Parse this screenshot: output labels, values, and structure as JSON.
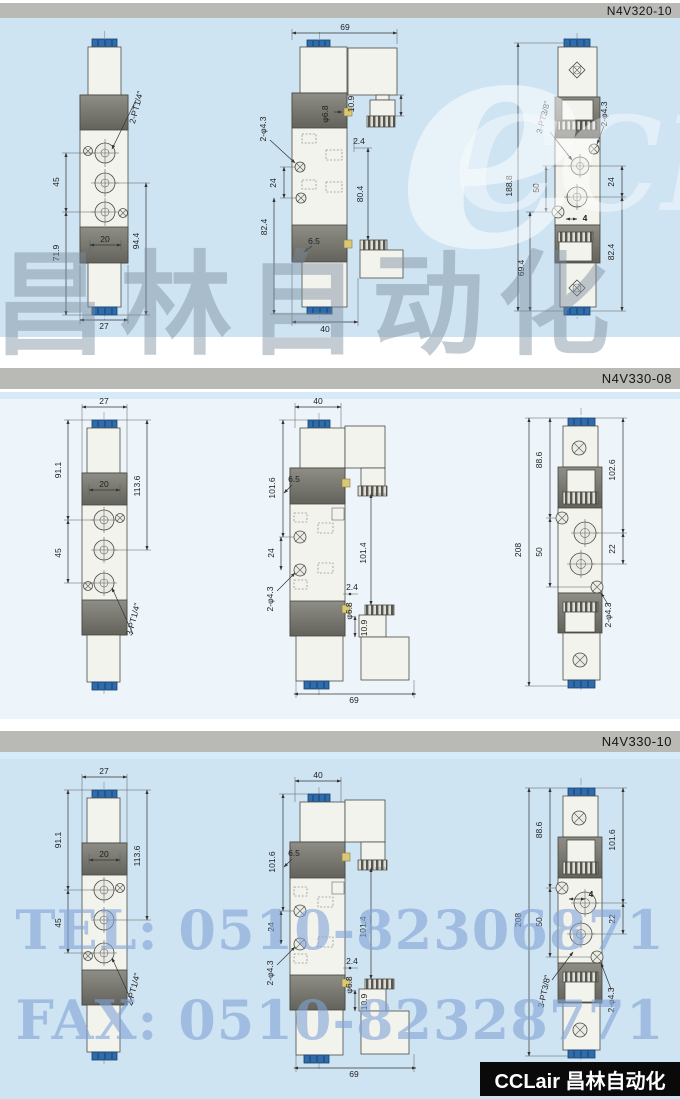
{
  "headers": [
    {
      "model": "N4V320-10"
    },
    {
      "model": "N4V330-08"
    },
    {
      "model": "N4V330-10"
    }
  ],
  "watermarks": {
    "brand": "CCLair",
    "logo_glyph": "e",
    "brand_cn": "昌林自动化",
    "tel": "TEL: 0510-82306871",
    "fax": "FAX: 0510-82328771",
    "footer": "CCLair 昌林自动化"
  },
  "sections": [
    {
      "model": "N4V320-10",
      "front": {
        "w27": "27",
        "d45": "45",
        "d719": "71.9",
        "d20": "20",
        "d944": "94.4",
        "port": "2-PT1/4\""
      },
      "side": {
        "w69": "69",
        "w40": "40",
        "d109": "10.9",
        "d68": "φ6.8",
        "d24s": "2.4",
        "d43": "2-φ4.3",
        "d24": "24",
        "d804": "80.4",
        "d824": "82.4",
        "d65": "6.5"
      },
      "back": {
        "d1888": "188.8",
        "d50": "50",
        "d694": "69.4",
        "port": "3-PT3/8\"",
        "d43": "2-φ4.3",
        "d24": "24",
        "d824": "82.4",
        "d4": "4"
      }
    },
    {
      "model": "N4V330-08",
      "front": {
        "w27": "27",
        "d911": "91.1",
        "d45": "45",
        "d20": "20",
        "d1136": "113.6",
        "port": "3-PT1/4\""
      },
      "side": {
        "w40": "40",
        "w69": "69",
        "d1016": "101.6",
        "d65": "6.5",
        "d24": "24",
        "d43": "2-φ4.3",
        "d1014": "101.4",
        "d24s": "2.4",
        "d68": "φ6.8",
        "d109": "10.9"
      },
      "back": {
        "d208": "208",
        "d886": "88.6",
        "d50": "50",
        "d1026": "102.6",
        "d22": "22",
        "d43": "2-φ4.3"
      }
    },
    {
      "model": "N4V330-10",
      "front": {
        "w27": "27",
        "d911": "91.1",
        "d45": "45",
        "d20": "20",
        "d1136": "113.6",
        "port": "2-PT1/4\""
      },
      "side": {
        "w40": "40",
        "w69": "69",
        "d1016": "101.6",
        "d65": "6.5",
        "d24": "24",
        "d43": "2-φ4.3",
        "d1014": "101.4",
        "d24s": "2.4",
        "d68": "φ6.8",
        "d109": "10.9"
      },
      "back": {
        "d208": "208",
        "d886": "88.6",
        "d50": "50",
        "d1016": "101.6",
        "d22": "22",
        "d43": "2-φ4.3",
        "port": "3-PT3/8\"",
        "d4": "4"
      }
    }
  ]
}
